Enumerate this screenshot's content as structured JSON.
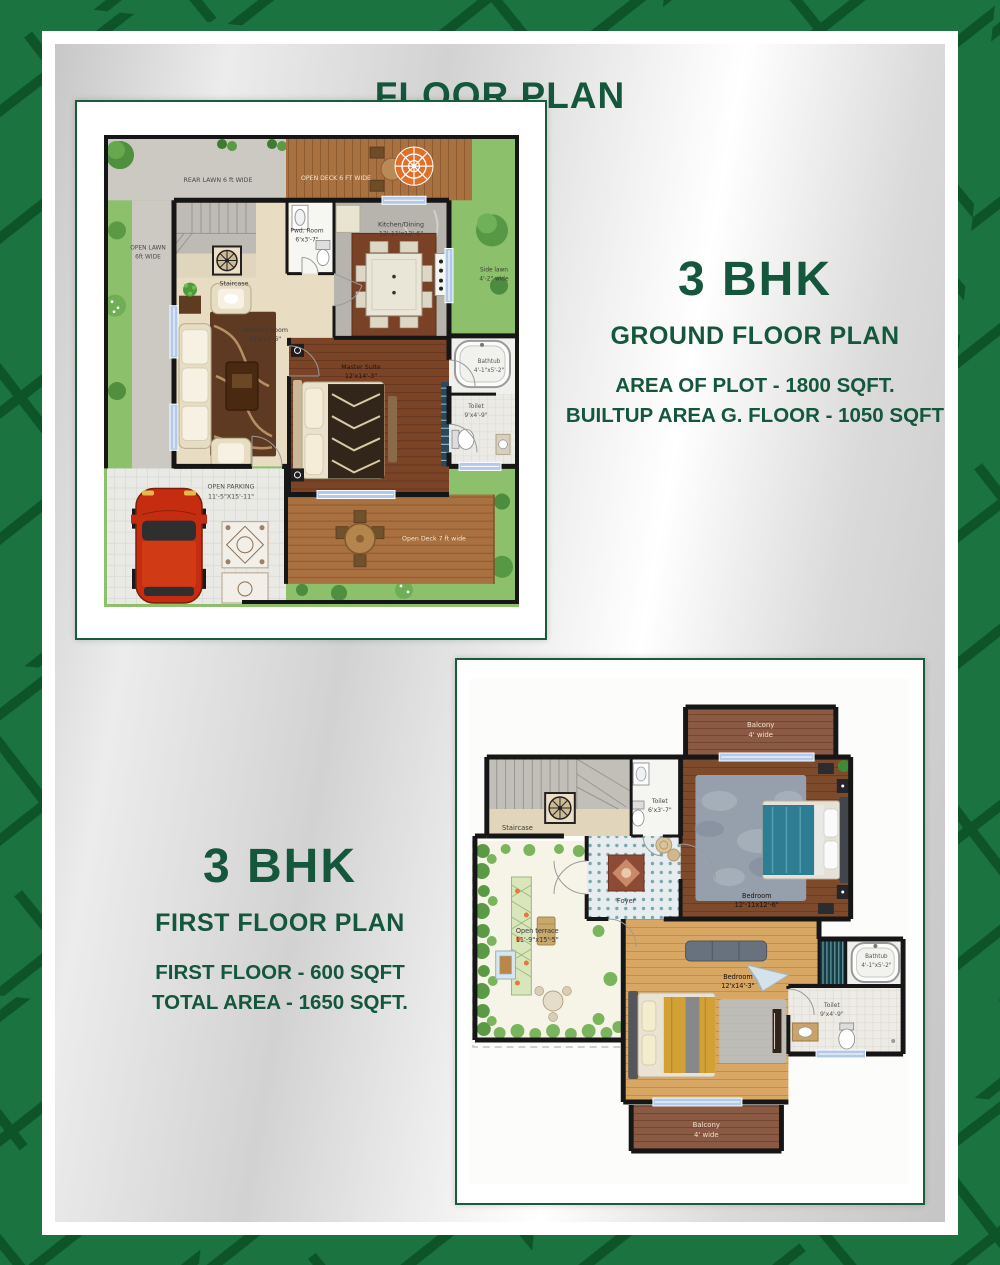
{
  "page": {
    "title": "FLOOR PLAN"
  },
  "colors": {
    "border_green": "#1b7340",
    "border_vein": "#0d5429",
    "heading_green": "#14573c",
    "frame_border": "#1a5b3c",
    "accent_umbrella": "#e06f28",
    "accent_car": "#c62d10"
  },
  "ground_floor": {
    "heading": "3 BHK",
    "subheading": "GROUND FLOOR PLAN",
    "area_line1": "AREA OF PLOT - 1800 SQFT.",
    "area_line2": "BUILTUP AREA G. FLOOR - 1050 SQFT",
    "labels": {
      "rear_lawn": "REAR LAWN 6 ft WIDE",
      "open_deck_top": "OPEN DECK 6 FT WIDE",
      "open_lawn_line1": "OPEN LAWN",
      "open_lawn_line2": "6ft WIDE",
      "side_lawn_line1": "Side lawn",
      "side_lawn_line2": "4'-2\" wide",
      "staircase": "Staircase",
      "pwd_room_line1": "Pwd. Room",
      "pwd_room_line2": "6'x3'-7\"",
      "kitchen_line1": "Kitchen/Dining",
      "kitchen_line2": "12'-11'x12'-6\"",
      "drawing_line1": "Drawing Room",
      "drawing_line2": "11'x14'-6\"",
      "master_line1": "Master Suite",
      "master_line2": "12'x14'-3\"",
      "bathtub_line1": "Bathtub",
      "bathtub_line2": "4'-1\"x5'-2\"",
      "toilet_line1": "Toilet",
      "toilet_line2": "9'x4'-9\"",
      "parking_line1": "OPEN PARKING",
      "parking_line2": "11'-5\"X15'-11\"",
      "open_deck_bottom": "Open Deck 7 ft wide"
    }
  },
  "first_floor": {
    "heading": "3 BHK",
    "subheading": "FIRST FLOOR PLAN",
    "area_line1": "FIRST FLOOR - 600 SQFT",
    "area_line2": "TOTAL AREA - 1650 SQFT.",
    "labels": {
      "balcony_top_line1": "Balcony",
      "balcony_top_line2": "4' wide",
      "staircase": "Staircase",
      "toilet1_line1": "Toilet",
      "toilet1_line2": "6'x3'-7\"",
      "bedroom1_line1": "Bedroom",
      "bedroom1_line2": "12'-11x12'-6\"",
      "foyer": "Foyer",
      "terrace_line1": "Open terrace",
      "terrace_line2": "11'-9\"x15'-5\"",
      "bedroom2_line1": "Bedroom",
      "bedroom2_line2": "12'x14'-3\"",
      "bathtub_line1": "Bathtub",
      "bathtub_line2": "4'-1\"x5'-2\"",
      "toilet2_line1": "Toilet",
      "toilet2_line2": "9'x4'-9\"",
      "balcony_bottom_line1": "Balcony",
      "balcony_bottom_line2": "4' wide"
    }
  }
}
